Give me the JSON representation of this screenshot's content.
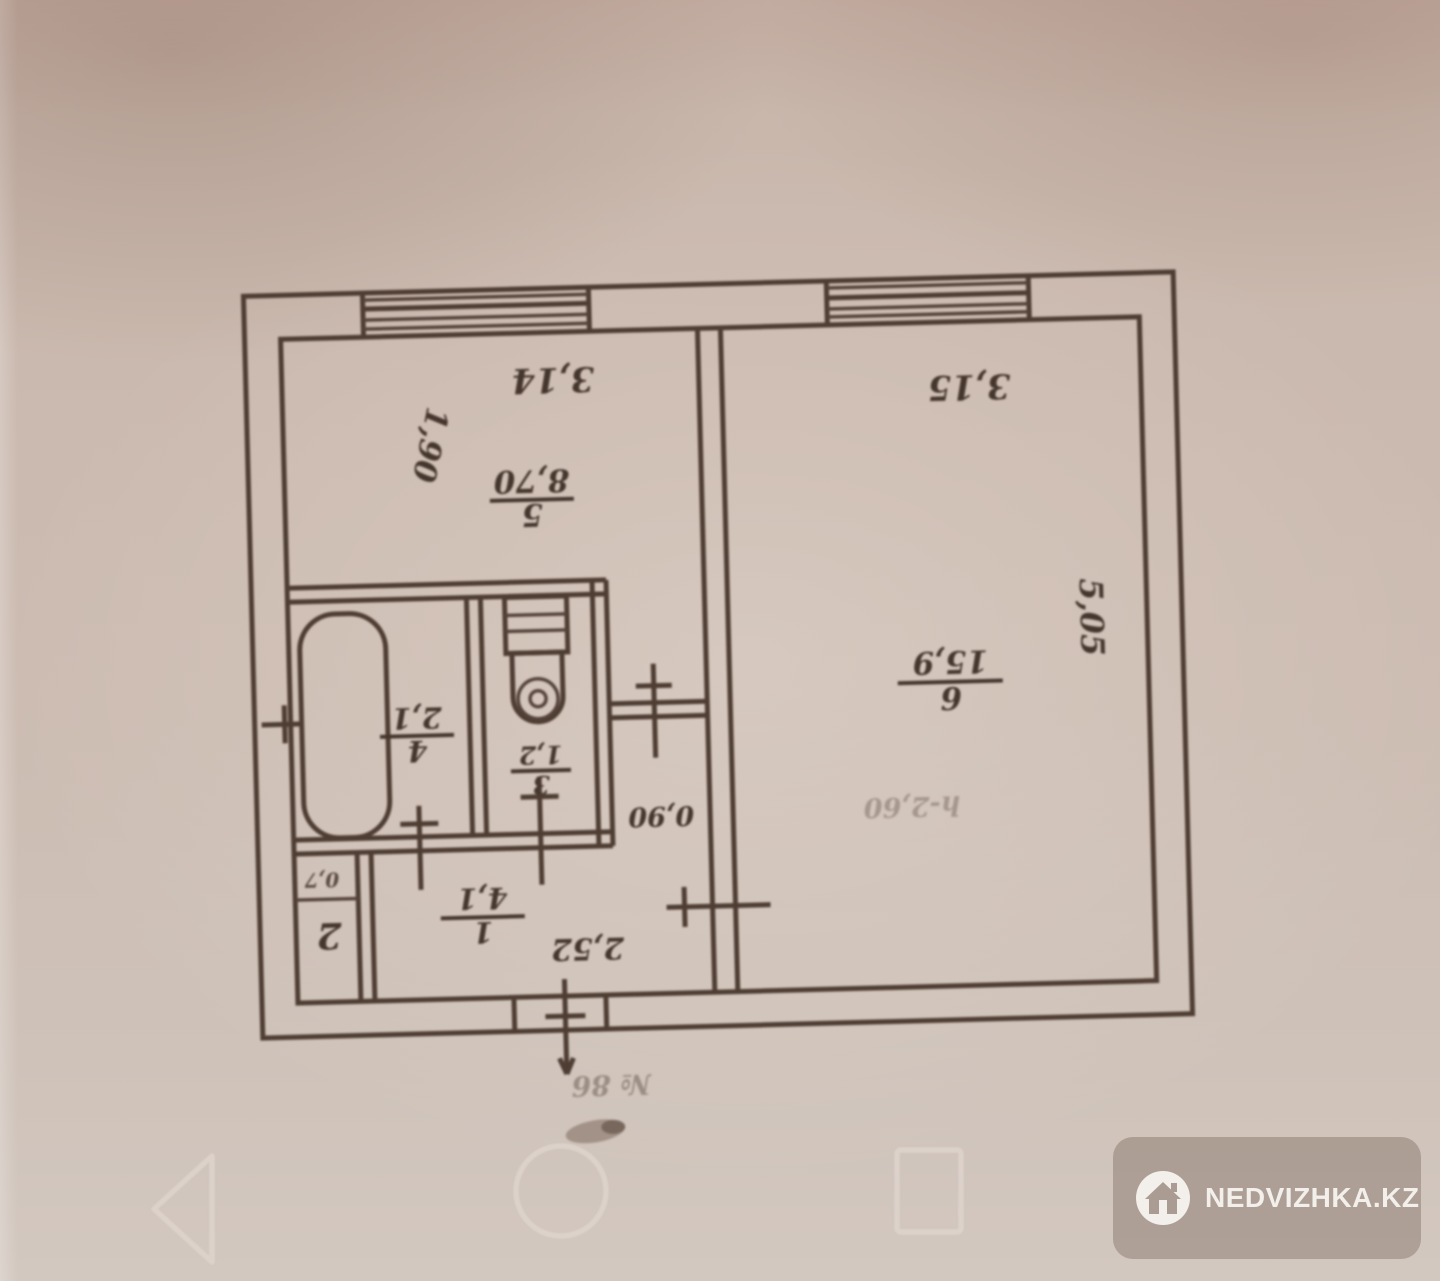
{
  "floor_plan": {
    "rooms": [
      {
        "name": "hall",
        "number": "1",
        "area": "4,1"
      },
      {
        "name": "closet",
        "number": "2",
        "area": "0,7"
      },
      {
        "name": "toilet",
        "number": "3",
        "area": "1,2"
      },
      {
        "name": "bathroom",
        "number": "4",
        "area": "2,1"
      },
      {
        "name": "kitchen",
        "number": "5",
        "area": "8,70"
      },
      {
        "name": "living",
        "number": "6",
        "area": "15,9"
      }
    ],
    "dimensions": {
      "kitchen_width": "3,14",
      "kitchen_depth": "1,90",
      "living_width": "3,15",
      "living_depth": "5,05",
      "hall_width": "2,52",
      "door_width": "0,90",
      "ceiling_height": "h-2,60"
    },
    "notes": {
      "bottom_number": "№ 86"
    }
  },
  "navbar": {
    "icons": [
      "back-triangle-icon",
      "home-circle-icon",
      "recents-square-icon"
    ]
  },
  "watermark": {
    "text": "NEDVIZHKA.KZ",
    "icon": "house-icon"
  },
  "colors": {
    "paper": "#cbbab0",
    "ink": "#4e3d33",
    "nav_icon": "#ded5cd",
    "watermark_bg": "#ab9c93",
    "watermark_fg": "#f3efeb"
  }
}
